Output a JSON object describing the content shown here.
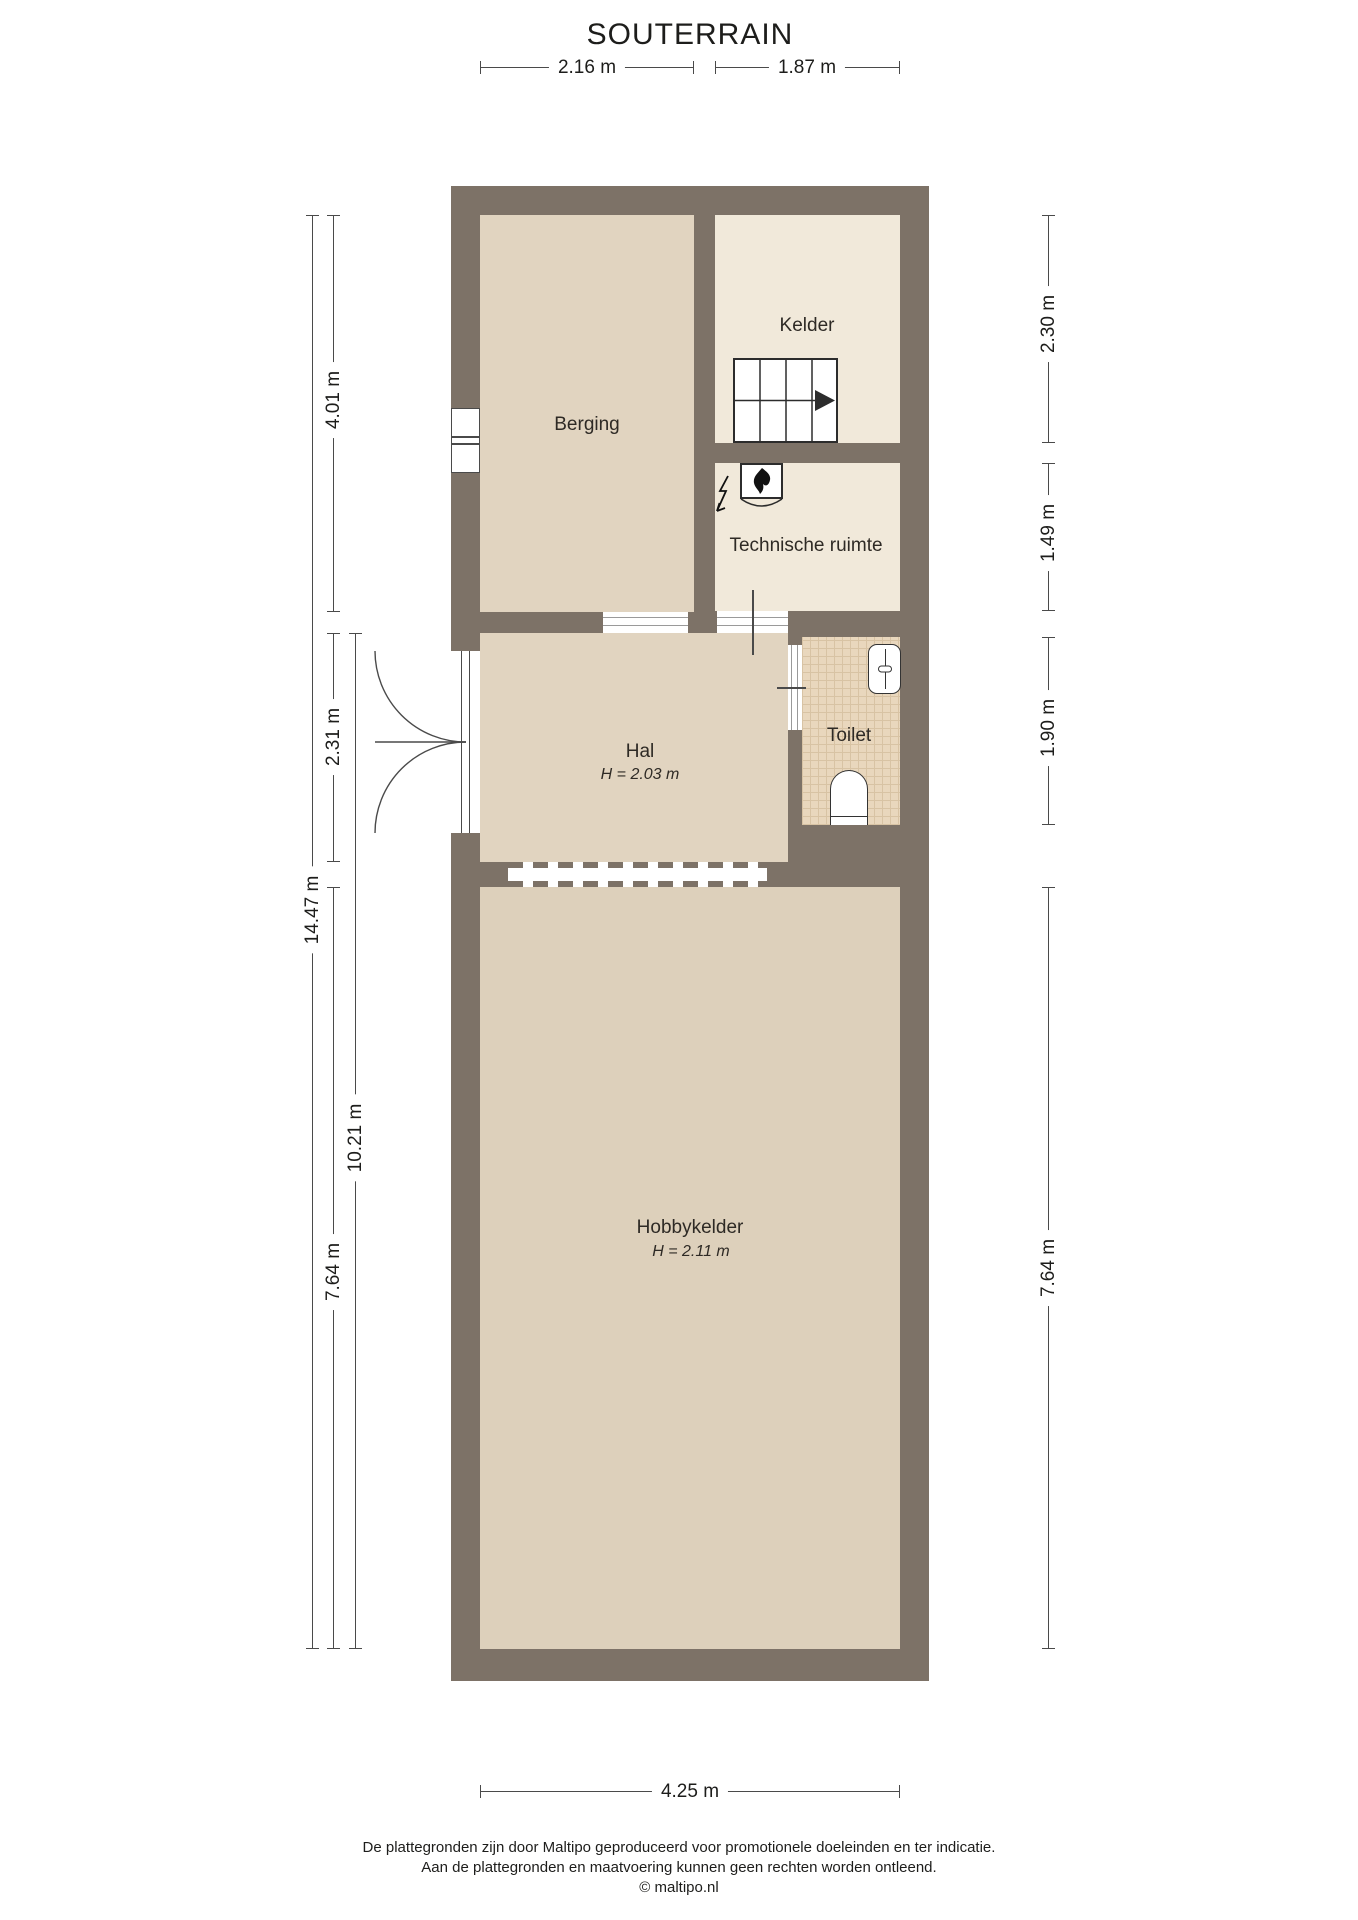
{
  "title": "SOUTERRAIN",
  "rooms": {
    "berging": {
      "label": "Berging"
    },
    "kelder": {
      "label": "Kelder"
    },
    "technische_ruimte": {
      "label": "Technische ruimte"
    },
    "hal": {
      "label": "Hal",
      "height": "H = 2.03 m"
    },
    "toilet": {
      "label": "Toilet"
    },
    "hobbykelder": {
      "label": "Hobbykelder",
      "height": "H = 2.11 m"
    }
  },
  "dimensions": {
    "top_left_width": "2.16 m",
    "top_right_width": "1.87 m",
    "left_berging_depth": "4.01 m",
    "left_hal_depth": "2.31 m",
    "left_total_depth": "14.47 m",
    "left_hal_hobby_depth": "10.21 m",
    "left_hobby_depth": "7.64 m",
    "right_kelder_depth": "2.30 m",
    "right_tech_depth": "1.49 m",
    "right_toilet_depth": "1.90 m",
    "right_hobby_depth": "7.64 m",
    "bottom_width": "4.25 m"
  },
  "footer": {
    "line1": "De plattegronden zijn door Maltipo geproduceerd voor promotionele doeleinden en ter indicatie.",
    "line2": "Aan de plattegronden en maatvoering kunnen geen rechten worden ontleend.",
    "line3": "© maltipo.nl"
  },
  "colors": {
    "wall": "#7d7267",
    "room_warm": "#e1d4c0",
    "room_warm_dark": "#ddd0bb",
    "room_light": "#f1e9da",
    "tile_base": "#e9d7bd",
    "tile_line": "#d8c3a4",
    "dim_line": "#4a4a4a",
    "text": "#1d1d1b"
  }
}
